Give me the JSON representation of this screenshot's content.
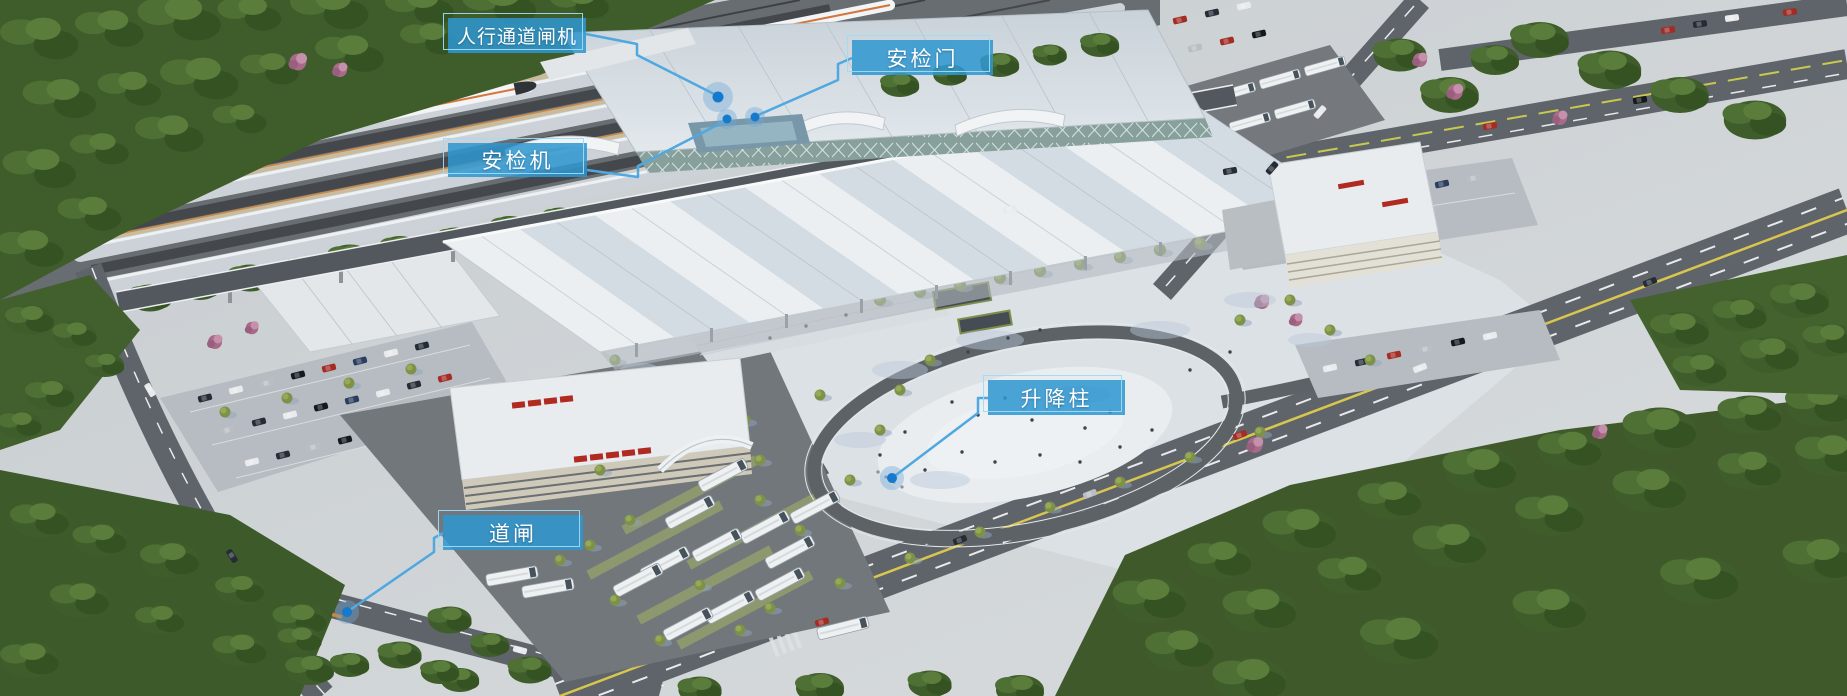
{
  "annotations": [
    {
      "id": "pedestrian-channel-gate",
      "label": "人行通道闸机"
    },
    {
      "id": "security-door",
      "label": "安检门"
    },
    {
      "id": "security-machine",
      "label": "安检机"
    },
    {
      "id": "lifting-bollard",
      "label": "升降柱"
    },
    {
      "id": "barrier-gate",
      "label": "道闸"
    }
  ],
  "colors": {
    "label_background": "#2e96cf",
    "label_border": "#9edcf5",
    "leader_line": "#4fa8e0",
    "marker_dot": "#1579cd",
    "marker_halo": "#6fa8d6"
  }
}
